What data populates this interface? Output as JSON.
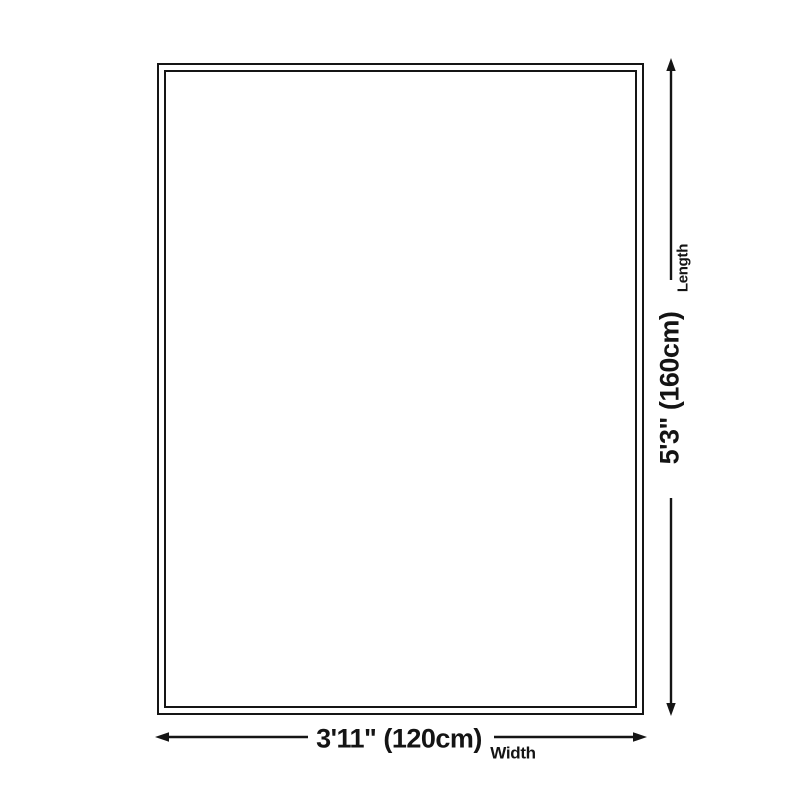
{
  "colors": {
    "line": "#151515",
    "text": "#141414",
    "background": "#ffffff"
  },
  "dimensions": {
    "length": {
      "value": "5'3\" (160cm)",
      "label": "Length"
    },
    "width": {
      "value": "3'11\" (120cm)",
      "label": "Width"
    }
  }
}
